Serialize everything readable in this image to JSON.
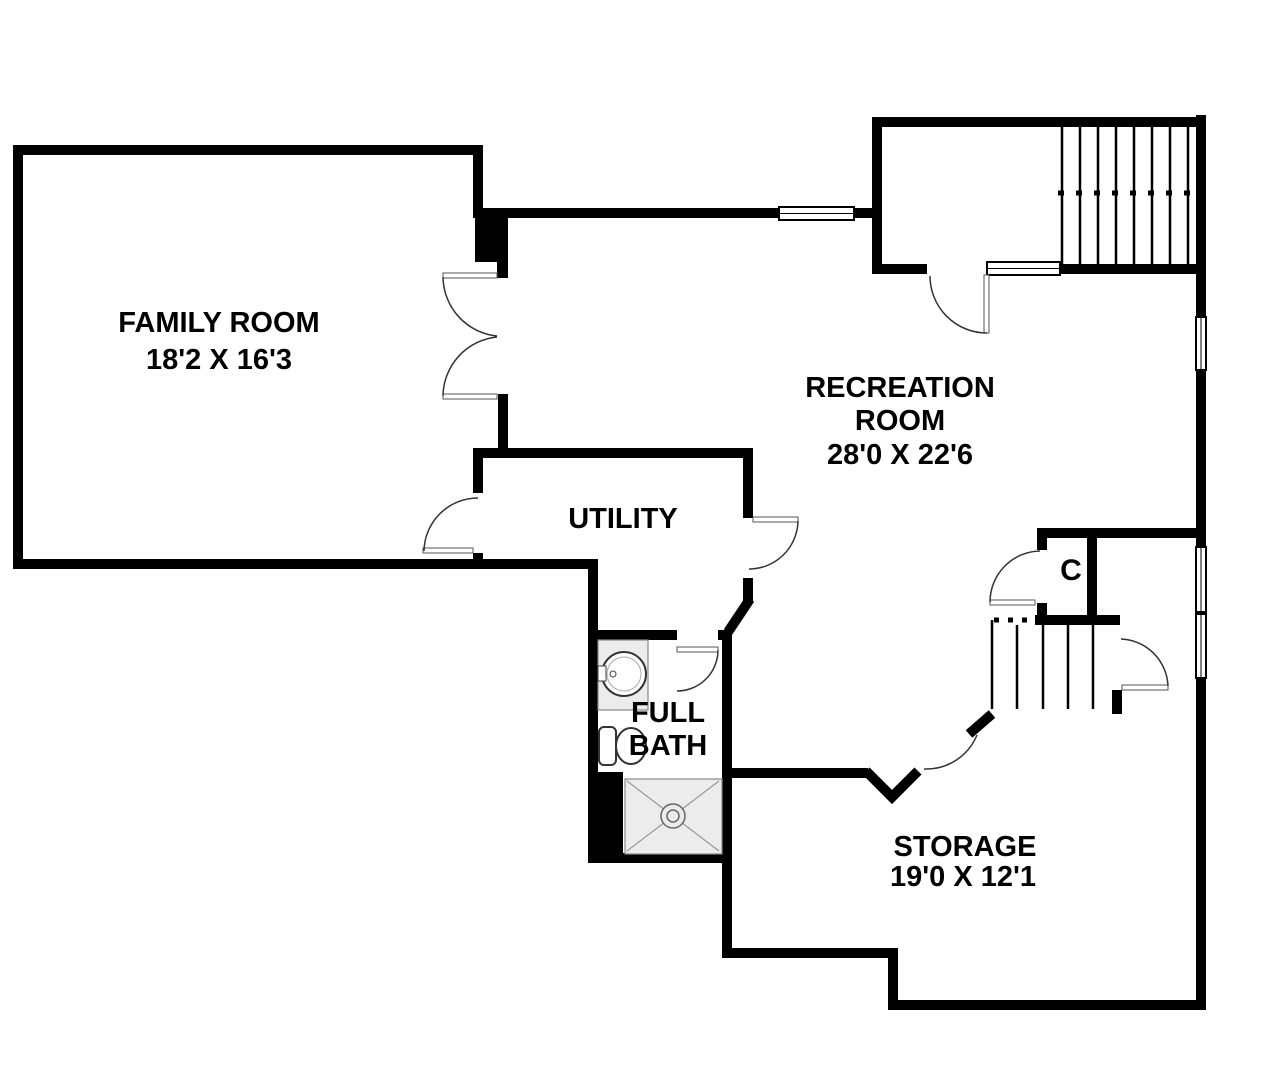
{
  "plan": {
    "rooms": {
      "family_room": {
        "name": "FAMILY ROOM",
        "dimensions": "18'2 X 16'3"
      },
      "recreation_room": {
        "name_line1": "RECREATION",
        "name_line2": "ROOM",
        "dimensions": "28'0 X 22'6"
      },
      "utility": {
        "name": "UTILITY"
      },
      "full_bath": {
        "name_line1": "FULL",
        "name_line2": "BATH"
      },
      "storage": {
        "name": "STORAGE",
        "dimensions": "19'0 X 12'1"
      },
      "closet": {
        "label": "C"
      }
    },
    "colors": {
      "wall": "#000000",
      "background": "#ffffff",
      "fixture_fill": "#ececec",
      "door_line": "#333333"
    }
  }
}
